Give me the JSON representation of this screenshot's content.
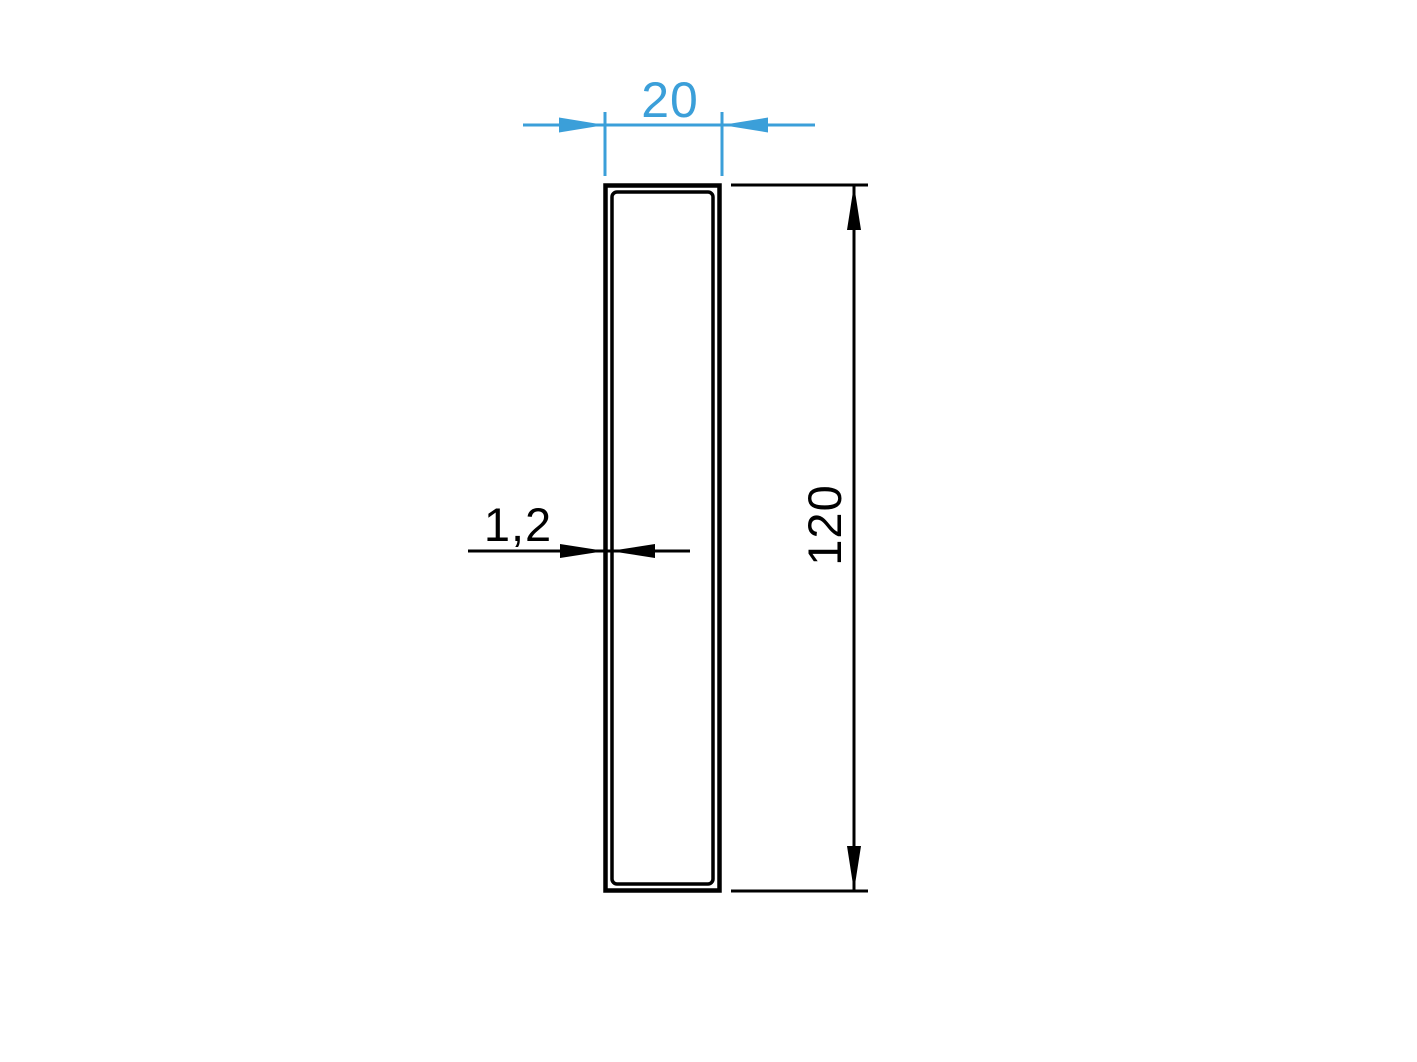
{
  "drawing": {
    "dimensions": {
      "width": {
        "label": "20"
      },
      "height": {
        "label": "120"
      },
      "wall_thickness": {
        "label": "1,2"
      }
    },
    "colors": {
      "dimension_blue": "#3B9FD9",
      "line_black": "#000000",
      "background": "#FFFFFF"
    }
  }
}
